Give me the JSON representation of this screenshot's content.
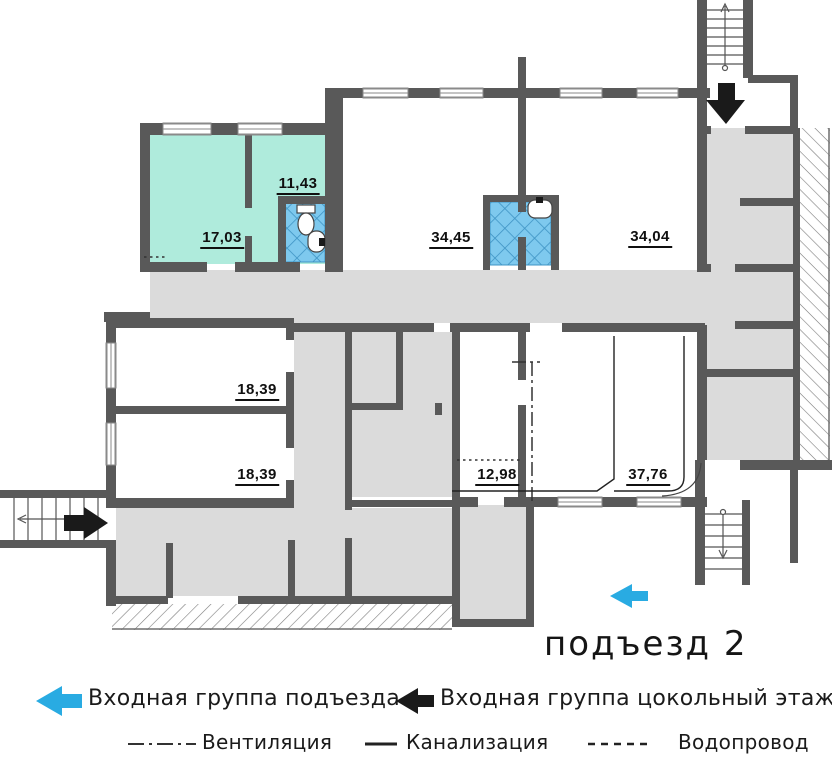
{
  "entrance_label": "подъезд 2",
  "rooms": [
    {
      "name": "room-17-03",
      "area": "17,03"
    },
    {
      "name": "room-11-43",
      "area": "11,43"
    },
    {
      "name": "room-34-45",
      "area": "34,45"
    },
    {
      "name": "room-34-04",
      "area": "34,04"
    },
    {
      "name": "room-18-39-upper",
      "area": "18,39"
    },
    {
      "name": "room-18-39-lower",
      "area": "18,39"
    },
    {
      "name": "room-12-98",
      "area": "12,98"
    },
    {
      "name": "room-37-76",
      "area": "37,76"
    }
  ],
  "legend": {
    "entrance_building": "Входная группа подъезда",
    "entrance_basement": "Входная группа цокольный этаж",
    "ventilation": "Вентиляция",
    "sewerage": "Канализация",
    "water": "Водопровод"
  },
  "colors": {
    "wall": "#595959",
    "corridor_gray": "#DBDBDB",
    "room_teal": "#AFEBDC",
    "bath_blue": "#7EC9EE",
    "bath_line": "#3F94C4",
    "accent_blue": "#29ABE2",
    "black": "#1A1A1A"
  }
}
